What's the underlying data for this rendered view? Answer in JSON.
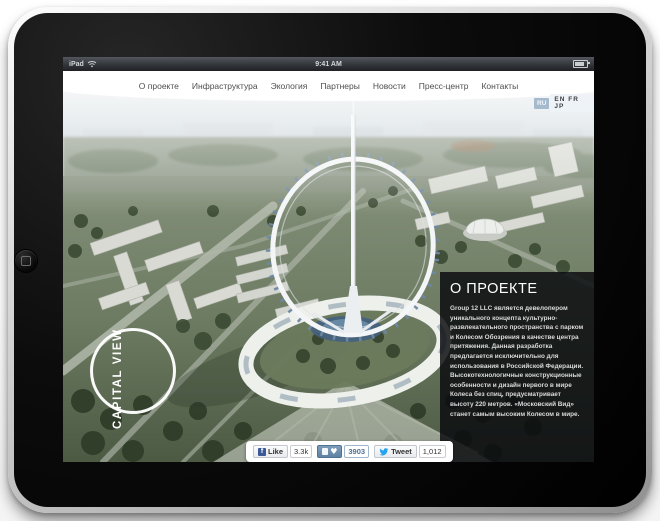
{
  "status_bar": {
    "device_label": "iPad",
    "time": "9:41 AM"
  },
  "nav": {
    "items": [
      "О проекте",
      "Инфраструктура",
      "Экология",
      "Партнеры",
      "Новости",
      "Пресс-центр",
      "Контакты"
    ]
  },
  "lang": {
    "selected": "RU",
    "options": "EN FR JP"
  },
  "logo": {
    "text": "CAPITAL VIEW"
  },
  "about": {
    "title": "О ПРОЕКТЕ",
    "body": "Group 12 LLC является девелопером уникального концепта культурно-развлекательного пространства с парком и Колесом Обозрения в качестве центра притяжения. Данная разработка предлагается исключительно для использования в Российской Федерации. Высокотехнологичные конструкционные особенности и дизайн первого в мире Колеса без спиц, предусматривает высоту 220 метров. «Московский Вид» станет самым высоким Колесом в мире."
  },
  "social": {
    "facebook_label": "Like",
    "facebook_count": "3.3k",
    "facebook_icon": "f",
    "vk_count": "3903",
    "vk_heart": "♥",
    "twitter_label": "Tweet",
    "twitter_count": "1,012"
  },
  "colors": {
    "fb_blue": "#3b5998",
    "vk_blue": "#6d8fb0",
    "twitter_blue": "#2aa3ef",
    "panel_bg": "rgba(9,11,14,0.84)",
    "accent_white": "#ffffff"
  }
}
